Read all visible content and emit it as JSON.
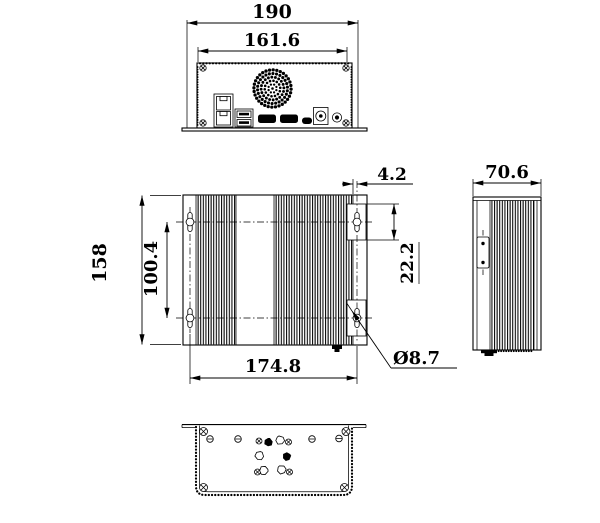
{
  "colors": {
    "line": "#000000",
    "background": "#ffffff"
  },
  "views": {
    "rear": {
      "dims": {
        "overall_width": "190",
        "body_width": "161.6"
      }
    },
    "plan": {
      "dims": {
        "depth": "158",
        "hole_spacing_vertical": "100.4",
        "hole_spacing_horizontal": "174.8",
        "fin_offset": "4.2",
        "boss_height": "22.2",
        "hole_diameter": "Ø8.7"
      }
    },
    "side": {
      "dims": {
        "width": "70.6"
      }
    }
  },
  "icons": [
    "fan-grille-icon",
    "ethernet-ports-icon",
    "usb-ports-icon",
    "hdmi-port-icon",
    "micro-usb-port-icon",
    "dc-jack-icon",
    "audio-jack-icon",
    "mounting-keyhole-icon",
    "corner-screw-icon",
    "slotted-screw-icon",
    "cross-screw-icon",
    "side-access-plate-icon",
    "front-button-icon"
  ]
}
